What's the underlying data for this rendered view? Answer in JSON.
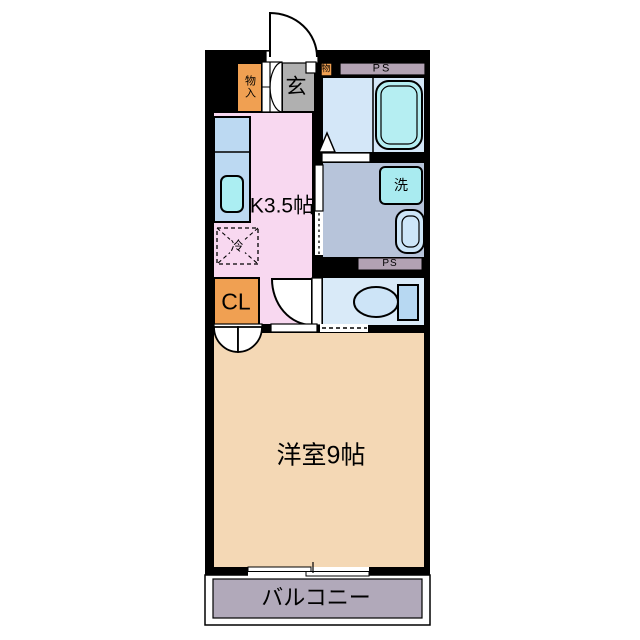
{
  "title": "1K apartment floor plan",
  "labels": {
    "entrance": "玄",
    "entrance_storage": "物入",
    "small_storage": "物",
    "ps_top": "PS",
    "washer": "洗",
    "kitchen": "K3.5帖",
    "refrigerator": "冷",
    "closet": "CL",
    "main_room": "洋室9帖",
    "ps_bottom": "PS",
    "balcony": "バルコニー"
  },
  "colors": {
    "wall": "#000000",
    "door": "#ffffff",
    "entrance_floor": "#b0b0b0",
    "storage": "#f0a052",
    "pipe_space": "#b2a2b3",
    "bathroom": "#d4e7f8",
    "bathtub": "#b5eef2",
    "washroom": "#b7c4da",
    "washer": "#a9ebf0",
    "basin": "#cde6f8",
    "toilet_room": "#d9eaf8",
    "toilet": "#cde4f7",
    "toilet_tank": "#b7d8f2",
    "kitchen": "#f8d8f0",
    "counter": "#bcd9f2",
    "sink": "#abeef2",
    "main_room": "#f4d8b5",
    "balcony": "#b1a9ba"
  }
}
